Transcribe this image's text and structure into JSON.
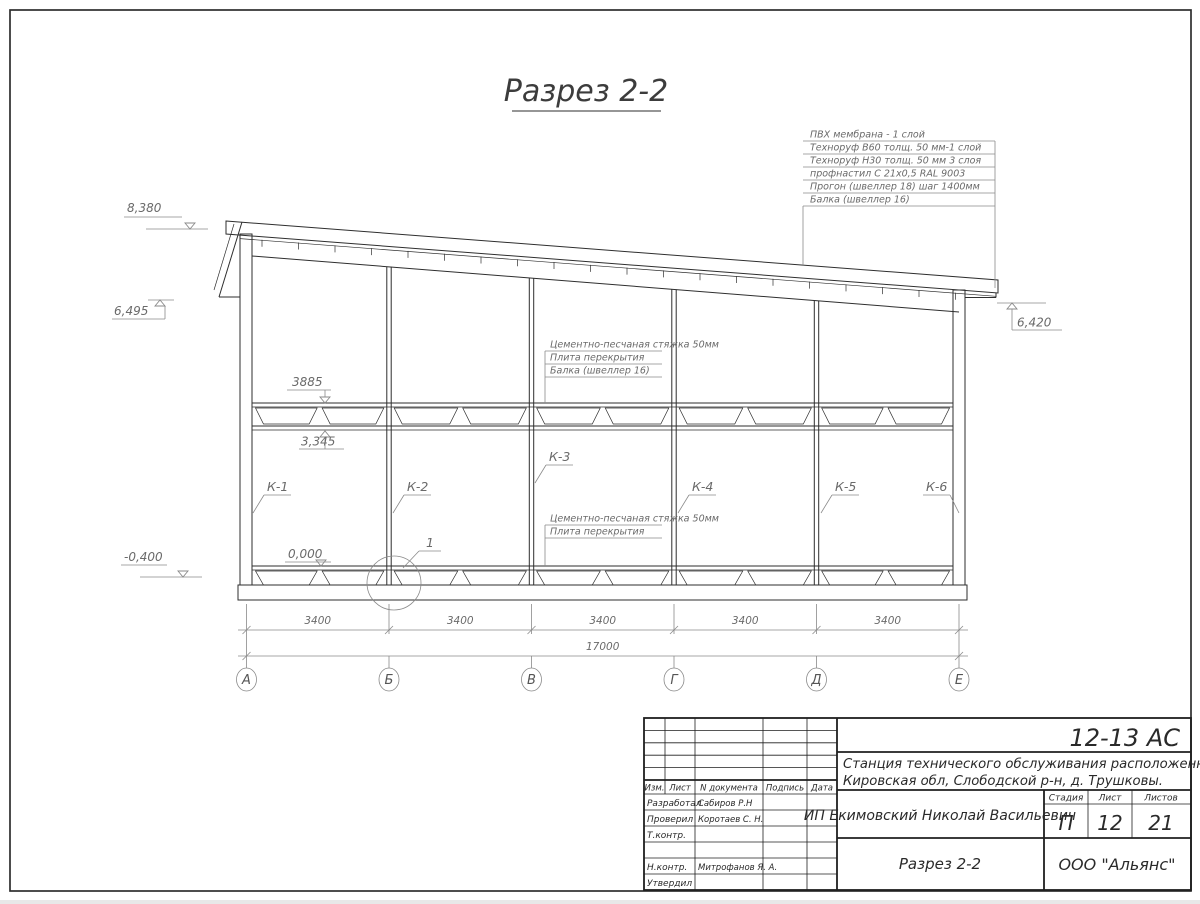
{
  "title": "Разрез 2-2",
  "roof_callout": [
    "ПВХ мембрана - 1 слой",
    "Техноруф В60 толщ. 50 мм-1 слой",
    "Техноруф Н30 толщ. 50 мм 3 слоя",
    "профнастил С 21х0,5 RAL 9003",
    "Прогон (швеллер 18) шаг 1400мм",
    "Балка (швеллер 16)"
  ],
  "floor_callout_upper": [
    "Цементно-песчаная стяжка 50мм",
    "Плита перекрытия",
    "Балка (швеллер 16)"
  ],
  "floor_callout_lower": [
    "Цементно-песчаная стяжка 50мм",
    "Плита перекрытия"
  ],
  "elevations": {
    "ridge": "8,380",
    "left_eave": "6,495",
    "right_eave": "6,420",
    "floor_top": "3885",
    "floor_bottom": "3,345",
    "zero": "0,000",
    "base": "-0,400"
  },
  "columns": {
    "k1": "К-1",
    "k2": "К-2",
    "k3": "К-3",
    "k4": "К-4",
    "k5": "К-5",
    "k6": "К-6"
  },
  "detail": {
    "label": "1"
  },
  "dims": {
    "bays": [
      "3400",
      "3400",
      "3400",
      "3400",
      "3400"
    ],
    "total": "17000"
  },
  "axes": [
    "А",
    "Б",
    "В",
    "Г",
    "Д",
    "Е"
  ],
  "title_block": {
    "code": "12-13 АС",
    "project_line1": "Станция технического обслуживания расположенная по адресу",
    "project_line2": "Кировская обл, Слободской р-н, д. Трушковы.",
    "client": "ИП Екимовский Николай Васильевич",
    "sheet_title": "Разрез 2-2",
    "company": "ООО \"Альянс\"",
    "header_cols": [
      "Изм.",
      "Лист",
      "N документа",
      "Подпись",
      "Дата"
    ],
    "stage_label": "Стадия",
    "sheet_label": "Лист",
    "sheets_label": "Листов",
    "stage": "П",
    "sheet": "12",
    "sheets": "21",
    "roles": [
      {
        "label": "Разработал",
        "name": "Сабиров Р.Н"
      },
      {
        "label": "Проверил",
        "name": "Коротаев С. Н."
      },
      {
        "label": "Т.контр.",
        "name": ""
      },
      {
        "label": "",
        "name": ""
      },
      {
        "label": "Н.контр.",
        "name": "Митрофанов Я. А."
      },
      {
        "label": "Утвердил",
        "name": ""
      }
    ]
  },
  "colors": {
    "line": "#2e2e2e",
    "annotation": "#6a6a6a",
    "hatch": "#a9afc2",
    "paper": "#ffffff"
  }
}
